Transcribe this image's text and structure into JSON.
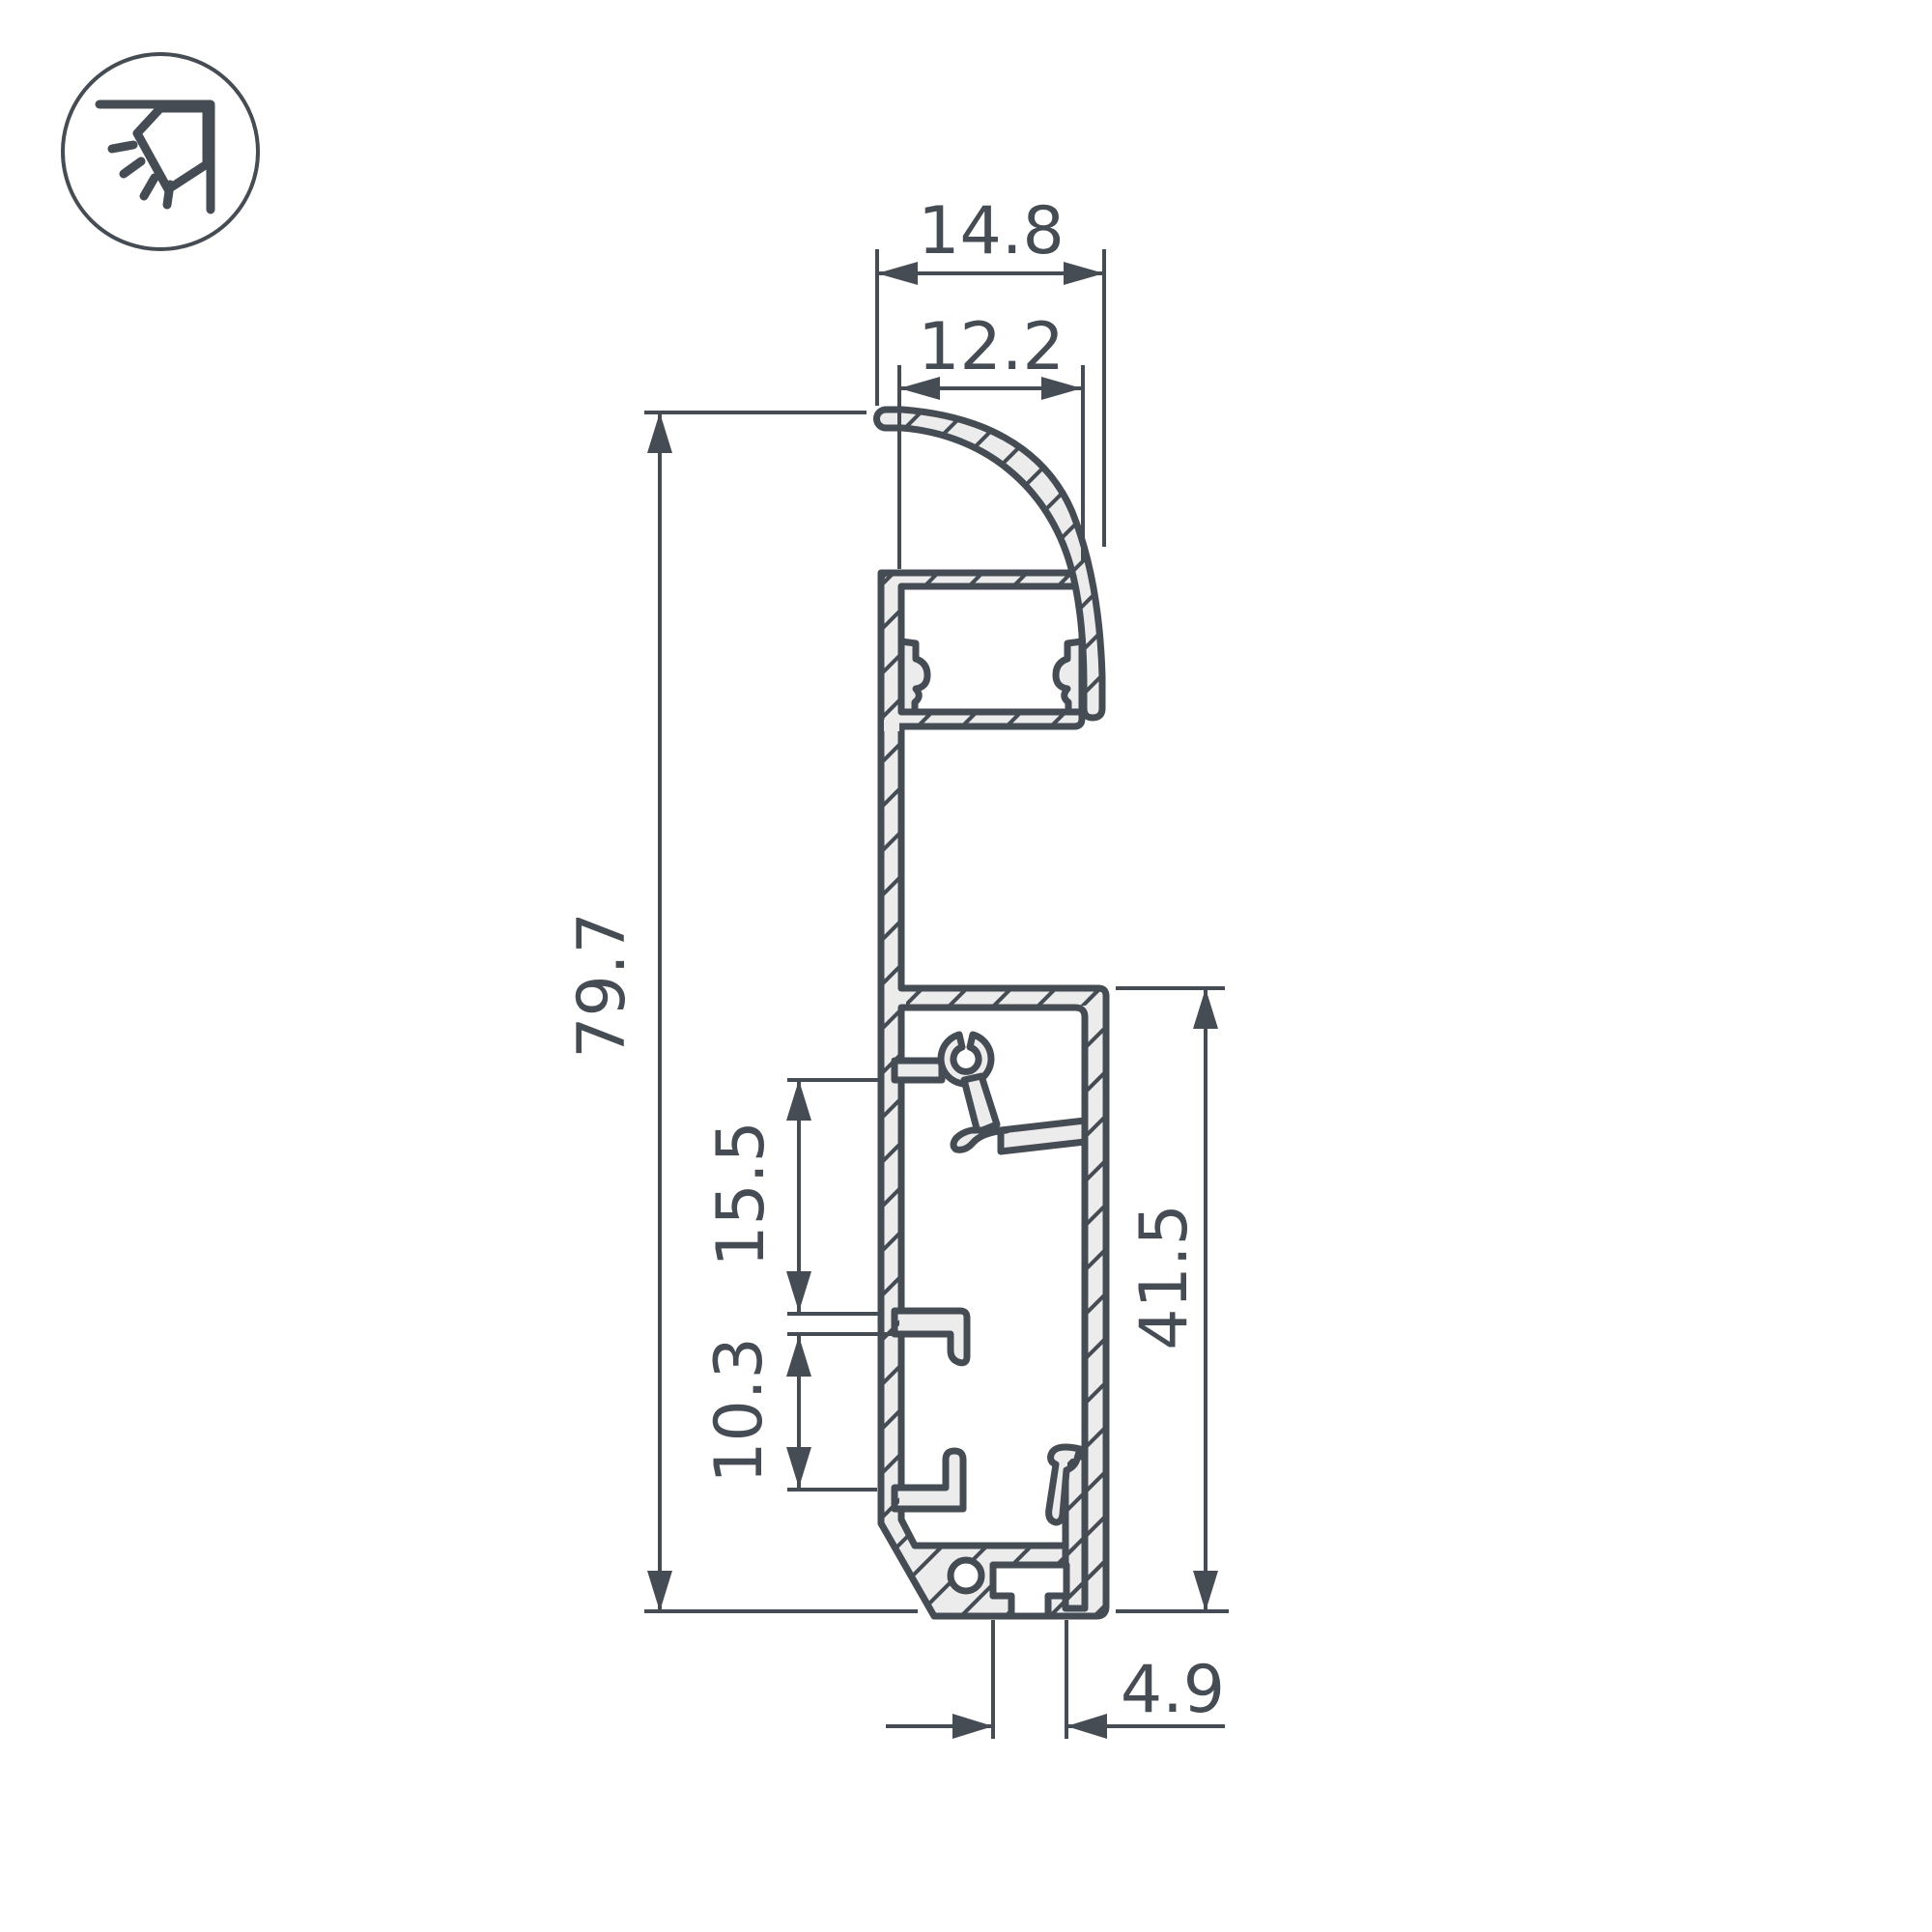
{
  "drawing": {
    "kind": "technical cross-section drawing",
    "colors": {
      "line": "#454C53",
      "fill": "#ECECED",
      "background": "#FFFFFF"
    }
  },
  "icon": {
    "name": "wall-washer-corner-light-icon"
  },
  "dimensions": {
    "outer_top_width": "14.8",
    "inner_top_width": "12.2",
    "total_height": "79.7",
    "upper_pocket_height": "15.5",
    "lower_pocket_height": "10.3",
    "right_section_height": "41.5",
    "bottom_slot_width": "4.9"
  }
}
